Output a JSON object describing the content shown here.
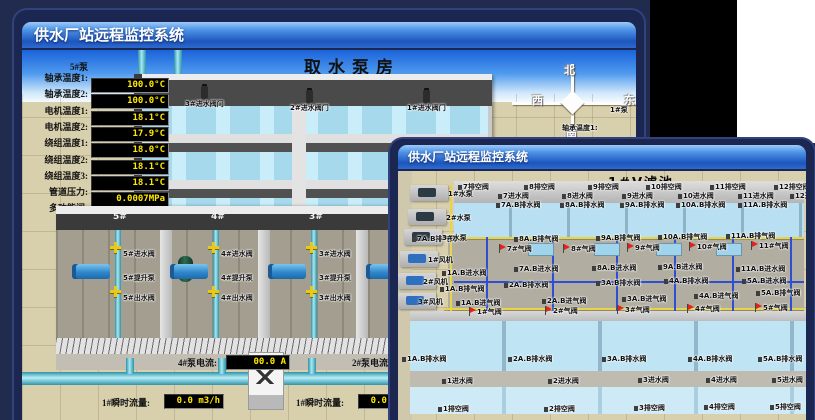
{
  "colors": {
    "navy_bg": "#202b4d",
    "title_blue": "#1d56bd",
    "sand": "#d8cfac",
    "water": "#b9e0f2",
    "led_bg": "#000000",
    "led_text": "#ffe900",
    "alarm_red": "#e2231a",
    "pipe_teal": "#2d93a8",
    "pipe_yellow": "#e8d44a"
  },
  "back_window": {
    "titlebar": "供水厂站远程监控系统",
    "scene_title": "取水泵房",
    "panel": {
      "pump_label": "5#泵",
      "rows": [
        {
          "label": "轴承温度1:",
          "value": "100.0°C"
        },
        {
          "label": "轴承温度2:",
          "value": "100.0°C"
        },
        {
          "label": "电机温度1:",
          "value": "18.1°C"
        },
        {
          "label": "电机温度2:",
          "value": "17.9°C"
        },
        {
          "label": "绕组温度1:",
          "value": "18.0°C"
        },
        {
          "label": "绕组温度2:",
          "value": "18.1°C"
        },
        {
          "label": "绕组温度3:",
          "value": "18.1°C"
        },
        {
          "label": "管道压力:",
          "value": "0.0007MPa"
        },
        {
          "label": "多功能阀:",
          "value": "0%"
        }
      ]
    },
    "inlet_valves": [
      {
        "label": "3#进水阀门",
        "x": 163,
        "y": 50
      },
      {
        "label": "2#进水阀门",
        "x": 268,
        "y": 54
      },
      {
        "label": "1#进水阀门",
        "x": 385,
        "y": 54
      }
    ],
    "compass": {
      "n": "北",
      "w": "西",
      "s": "南",
      "e": "东"
    },
    "bays": [
      {
        "no": "5#",
        "cx": 96,
        "in": "5#进水阀",
        "pump": "5#提升泵",
        "out": "5#出水阀"
      },
      {
        "no": "4#",
        "cx": 194,
        "in": "4#进水阀",
        "pump": "4#提升泵",
        "out": "4#出水阀"
      },
      {
        "no": "3#",
        "cx": 292,
        "in": "3#进水阀",
        "pump": "3#提升泵",
        "out": "3#出水阀"
      },
      {
        "no": "2#",
        "cx": 390
      }
    ],
    "current": [
      {
        "label": "4#泵电流:",
        "value": "00.0 A",
        "x": 156
      },
      {
        "label": "2#泵电流:",
        "value": "",
        "x": 330
      }
    ],
    "flows": [
      {
        "label": "1#瞬时流量:",
        "value": "0.0 m3/h",
        "x": 80
      },
      {
        "label": "1#瞬时流量:",
        "value": "0.0 m3/h",
        "x": 274
      }
    ],
    "right_labels": [
      {
        "t": "1#泵",
        "x": 588,
        "y": 56
      },
      {
        "t": "轴承温度1:",
        "x": 540,
        "y": 74
      },
      {
        "t": "轴承温度2:",
        "x": 540,
        "y": 92
      }
    ]
  },
  "front_window": {
    "titlebar": "供水厂站远程监控系统",
    "scene_title": "1#V滤池",
    "equipment": [
      {
        "t": "1#水泵",
        "x": 50,
        "y": 18
      },
      {
        "t": "2#水泵",
        "x": 48,
        "y": 42
      },
      {
        "t": "3#水泵",
        "x": 44,
        "y": 62
      },
      {
        "t": "1#风机",
        "x": 30,
        "y": 84
      },
      {
        "t": "2#风机",
        "x": 25,
        "y": 106
      },
      {
        "t": "3#风机",
        "x": 20,
        "y": 126
      }
    ],
    "labels": [
      {
        "t": "7排空阀",
        "x": 60,
        "y": 12
      },
      {
        "t": "8排空阀",
        "x": 126,
        "y": 12
      },
      {
        "t": "9排空阀",
        "x": 190,
        "y": 12
      },
      {
        "t": "10排空阀",
        "x": 248,
        "y": 12
      },
      {
        "t": "11排空阀",
        "x": 312,
        "y": 12
      },
      {
        "t": "12排空阀",
        "x": 376,
        "y": 12
      },
      {
        "t": "7进水阀",
        "x": 100,
        "y": 21
      },
      {
        "t": "8进水阀",
        "x": 164,
        "y": 21
      },
      {
        "t": "9进水阀",
        "x": 224,
        "y": 21
      },
      {
        "t": "10进水阀",
        "x": 280,
        "y": 21
      },
      {
        "t": "11进水阀",
        "x": 340,
        "y": 21
      },
      {
        "t": "12进水阀",
        "x": 392,
        "y": 21
      },
      {
        "t": "7A.B排水阀",
        "x": 98,
        "y": 30
      },
      {
        "t": "8A.B排水阀",
        "x": 162,
        "y": 30
      },
      {
        "t": "9A.B排水阀",
        "x": 222,
        "y": 30
      },
      {
        "t": "10A.B排水阀",
        "x": 278,
        "y": 30
      },
      {
        "t": "11A.B排水阀",
        "x": 340,
        "y": 30
      },
      {
        "t": "7A.B排气阀",
        "x": 14,
        "y": 64
      },
      {
        "t": "8A.B排气阀",
        "x": 116,
        "y": 64
      },
      {
        "t": "9A.B排气阀",
        "x": 198,
        "y": 63
      },
      {
        "t": "10A.B排气阀",
        "x": 260,
        "y": 62
      },
      {
        "t": "11A.B排气阀",
        "x": 328,
        "y": 61
      },
      {
        "t": "7#气阀",
        "x": 104,
        "y": 74,
        "r": 1
      },
      {
        "t": "8#气阀",
        "x": 168,
        "y": 74,
        "r": 1
      },
      {
        "t": "9#气阀",
        "x": 232,
        "y": 73,
        "r": 1
      },
      {
        "t": "10#气阀",
        "x": 294,
        "y": 72,
        "r": 1
      },
      {
        "t": "11#气阀",
        "x": 356,
        "y": 71,
        "r": 1
      },
      {
        "t": "1A.B进水阀",
        "x": 44,
        "y": 98
      },
      {
        "t": "7A.B进水阀",
        "x": 116,
        "y": 94
      },
      {
        "t": "8A.B进水阀",
        "x": 194,
        "y": 93
      },
      {
        "t": "9A.B进水阀",
        "x": 260,
        "y": 92
      },
      {
        "t": "11A.B进水阀",
        "x": 338,
        "y": 94
      },
      {
        "t": "1A.B排气阀",
        "x": 42,
        "y": 114
      },
      {
        "t": "2A.B排水阀",
        "x": 106,
        "y": 110
      },
      {
        "t": "3A.B排水阀",
        "x": 198,
        "y": 108
      },
      {
        "t": "4A.B排水阀",
        "x": 266,
        "y": 106
      },
      {
        "t": "5A.B进水阀",
        "x": 344,
        "y": 106
      },
      {
        "t": "1A.B进气阀",
        "x": 58,
        "y": 128
      },
      {
        "t": "2A.B进气阀",
        "x": 144,
        "y": 126
      },
      {
        "t": "3A.B进气阀",
        "x": 224,
        "y": 124
      },
      {
        "t": "4A.B进气阀",
        "x": 296,
        "y": 121
      },
      {
        "t": "5A.B排气阀",
        "x": 358,
        "y": 118
      },
      {
        "t": "1#气阀",
        "x": 74,
        "y": 137,
        "r": 1
      },
      {
        "t": "2#气阀",
        "x": 150,
        "y": 136,
        "r": 1
      },
      {
        "t": "3#气阀",
        "x": 222,
        "y": 135,
        "r": 1
      },
      {
        "t": "4#气阀",
        "x": 292,
        "y": 134,
        "r": 1
      },
      {
        "t": "5#气阀",
        "x": 360,
        "y": 133,
        "r": 1
      },
      {
        "t": "1A.B排水阀",
        "x": 4,
        "y": 184
      },
      {
        "t": "2A.B排水阀",
        "x": 110,
        "y": 184
      },
      {
        "t": "3A.B排水阀",
        "x": 204,
        "y": 184
      },
      {
        "t": "4A.B排水阀",
        "x": 290,
        "y": 184
      },
      {
        "t": "5A.B排水阀",
        "x": 360,
        "y": 184
      },
      {
        "t": "1进水阀",
        "x": 44,
        "y": 206
      },
      {
        "t": "2进水阀",
        "x": 150,
        "y": 206
      },
      {
        "t": "3进水阀",
        "x": 240,
        "y": 205
      },
      {
        "t": "4进水阀",
        "x": 308,
        "y": 205
      },
      {
        "t": "5进水阀",
        "x": 374,
        "y": 205
      },
      {
        "t": "1排空阀",
        "x": 40,
        "y": 234
      },
      {
        "t": "2排空阀",
        "x": 146,
        "y": 234
      },
      {
        "t": "3排空阀",
        "x": 236,
        "y": 233
      },
      {
        "t": "4排空阀",
        "x": 306,
        "y": 232
      },
      {
        "t": "5排空阀",
        "x": 372,
        "y": 232
      }
    ]
  }
}
